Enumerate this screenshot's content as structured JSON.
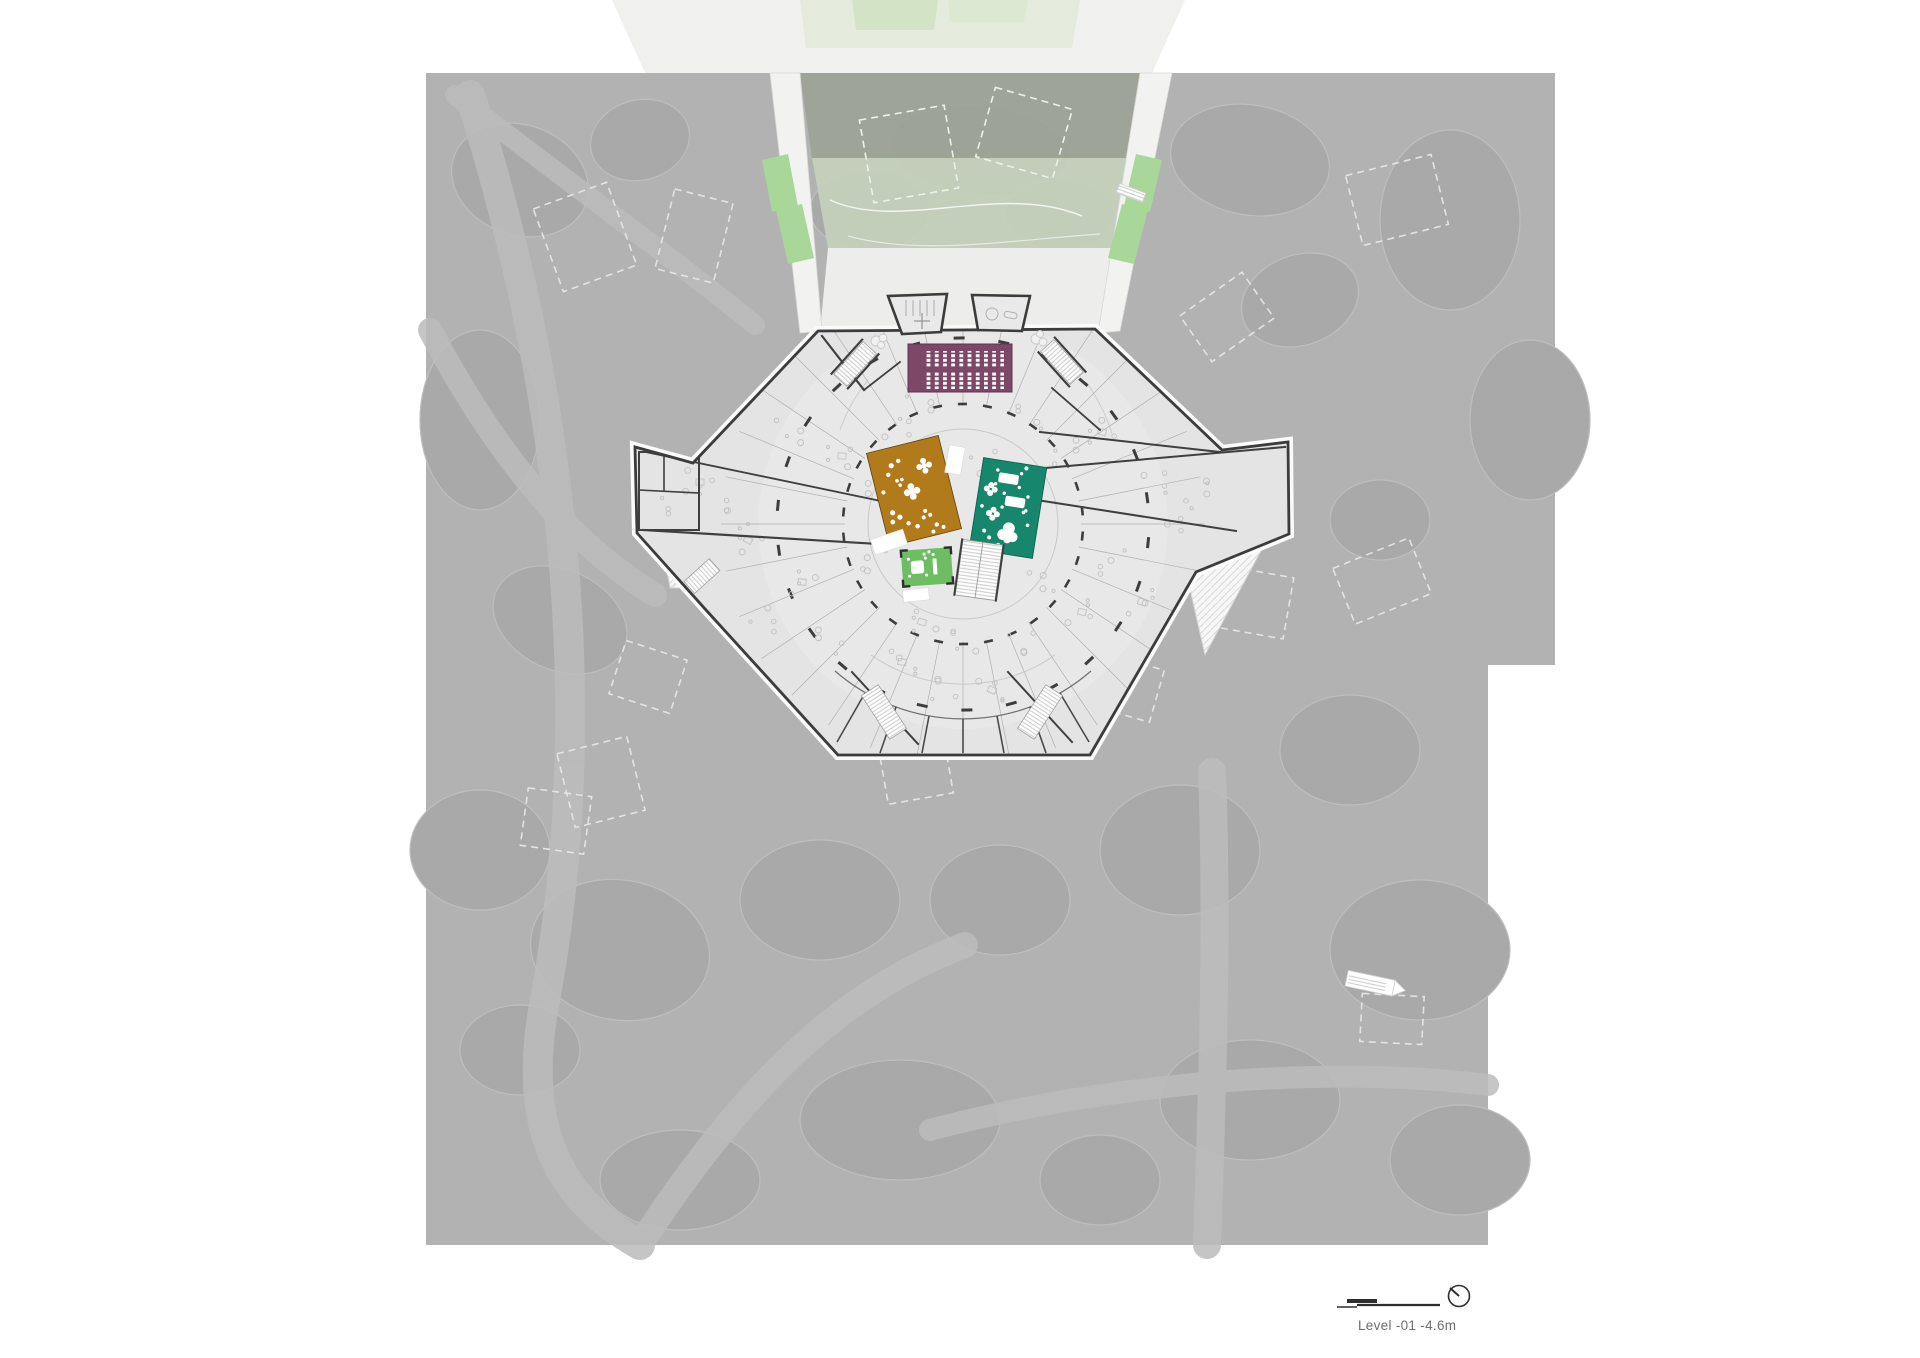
{
  "document": {
    "type": "architectural-floor-plan",
    "level_label": "Level -01  -4.6m"
  },
  "legend": {
    "scale_bar_icon": "graphic-scale-bar",
    "north_arrow_icon": "circle-with-needle"
  },
  "colors": {
    "page": "#ffffff",
    "site": "#b2b2b2",
    "site_blob": "#a9a9a9",
    "site_path": "#bdbdbd",
    "plaza": "#ededec",
    "courtyard_upper": "#9ca295",
    "courtyard_overlay": "#c5d1bc",
    "green_strip": "#a9d79a",
    "top_lawn": "#cfe2c3",
    "top_lawn_light": "#dce8d2",
    "top_band": "#f0f0ef",
    "building_fill": "#e4e4e4",
    "building_inner": "#e9e9e9",
    "building_outline": "#3c3c3c",
    "auditorium_purple": "#7d4767",
    "box_brown": "#b17a1b",
    "box_teal": "#16866c",
    "box_green": "#6fbd62",
    "seat_white": "#ffffff",
    "label_text": "#6e6e6e",
    "scalebar_ink": "#2e2e2e"
  }
}
